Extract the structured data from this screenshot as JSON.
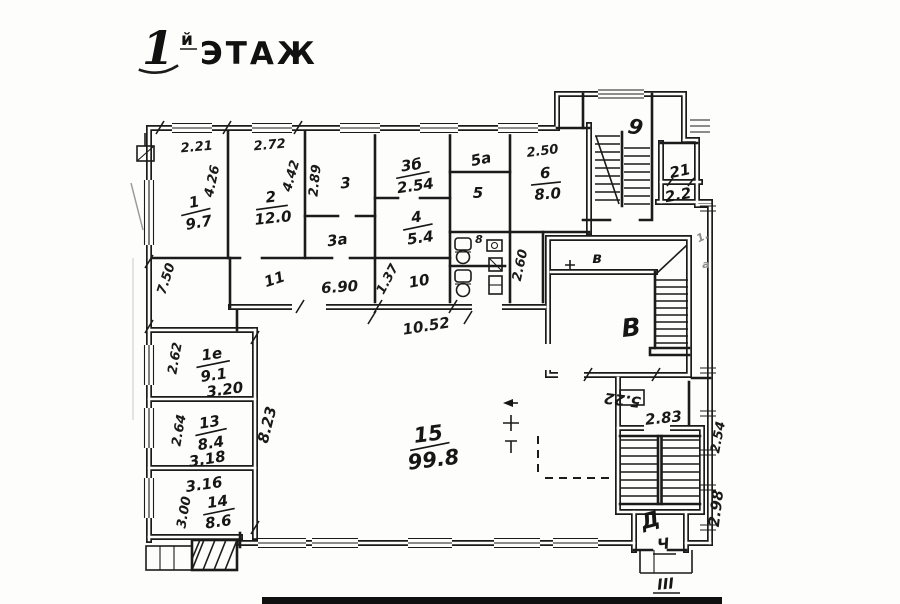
{
  "title": {
    "number": "1",
    "suffix": "й",
    "word": "ЭТАЖ"
  },
  "rooms": {
    "r1": {
      "num": "1",
      "area": "9.7"
    },
    "r2": {
      "num": "2",
      "area": "12.0"
    },
    "r3": {
      "num": "3"
    },
    "r3a": {
      "num": "3а"
    },
    "r3b": {
      "num": "3б",
      "area": "2.54"
    },
    "r4": {
      "num": "4",
      "area": "5.4"
    },
    "r5a": {
      "num": "5а"
    },
    "r5": {
      "num": "5"
    },
    "r6": {
      "num": "6",
      "area": "8.0"
    },
    "r8": {
      "num": "8"
    },
    "r9": {
      "num": "9"
    },
    "r10": {
      "num": "10"
    },
    "r11": {
      "num": "11"
    },
    "r1e": {
      "num": "1е",
      "area": "9.1",
      "width": "3.20"
    },
    "r13": {
      "num": "13",
      "area": "8.4",
      "width": "3.18"
    },
    "r14": {
      "num": "14",
      "area": "8.6",
      "width": "3.16"
    },
    "r15": {
      "num": "15",
      "area": "99.8"
    },
    "r21": {
      "num": "21",
      "area": "2.2"
    },
    "rv": {
      "num": "в"
    },
    "rV": {
      "num": "В"
    },
    "rD": {
      "num": "Д"
    },
    "rCh": {
      "num": "Ч"
    },
    "entrance": {
      "num": "III"
    }
  },
  "dims": {
    "top_room1": "2.21",
    "top_room2": "2.72",
    "room1_side": "4.26",
    "room2_side": "4.42",
    "room3_side": "2.89",
    "room6_top": "2.50",
    "corridor_left": "7.50",
    "room10_side": "1.37",
    "shaft_side": "2.60",
    "corridor_width": "6.90",
    "corridor_length": "10.52",
    "room1e_side": "2.62",
    "room13_side": "2.64",
    "room14_side": "3.00",
    "hall_side": "8.23",
    "roomv_bottom": "5.22",
    "staird_top": "2.83",
    "right_upper": "2.54",
    "right_lower": "2.98"
  },
  "marks": {
    "edge_top": "1.",
    "edge_mid": "а"
  },
  "colors": {
    "ink": "#1b1b1b",
    "paper": "#fdfdfc"
  }
}
